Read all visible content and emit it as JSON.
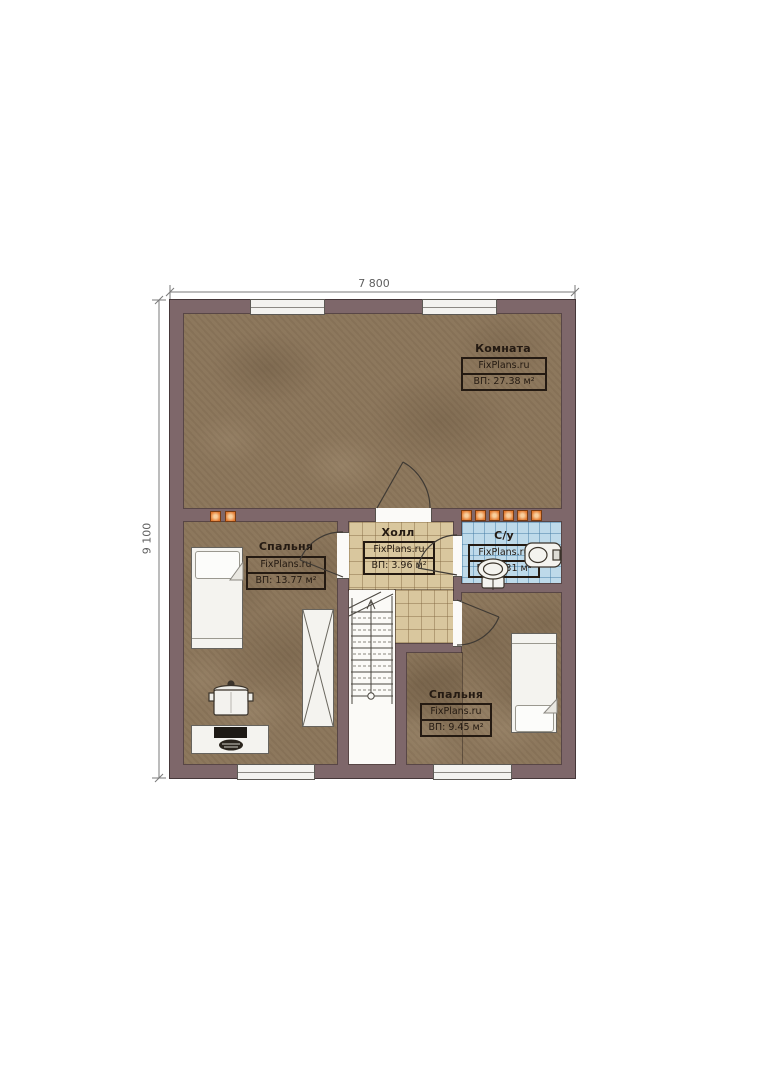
{
  "plan": {
    "dimension_top": "7 800",
    "dimension_left": "9 100",
    "watermark": "FixPlans.ru",
    "rooms": [
      {
        "name": "Комната",
        "watermark": "FixPlans.ru",
        "area": "ВП: 27.38 м²"
      },
      {
        "name": "Спальня",
        "watermark": "FixPlans.ru",
        "area": "ВП: 13.77 м²"
      },
      {
        "name": "Холл",
        "watermark": "FixPlans.ru",
        "area": "ВП: 3.96 м²"
      },
      {
        "name": "С/у",
        "watermark": "FixPlans.ru",
        "area": "ВП: 2.31 м²"
      },
      {
        "name": "Спальня",
        "watermark": "FixPlans.ru",
        "area": "ВП: 9.45 м²"
      }
    ],
    "colors": {
      "wall": "#7e676a",
      "wood_floor": "#8b755a",
      "hall_tile": "#d9c79e",
      "bath_tile": "#bedaea",
      "accent_orange": "#e2792f"
    }
  }
}
